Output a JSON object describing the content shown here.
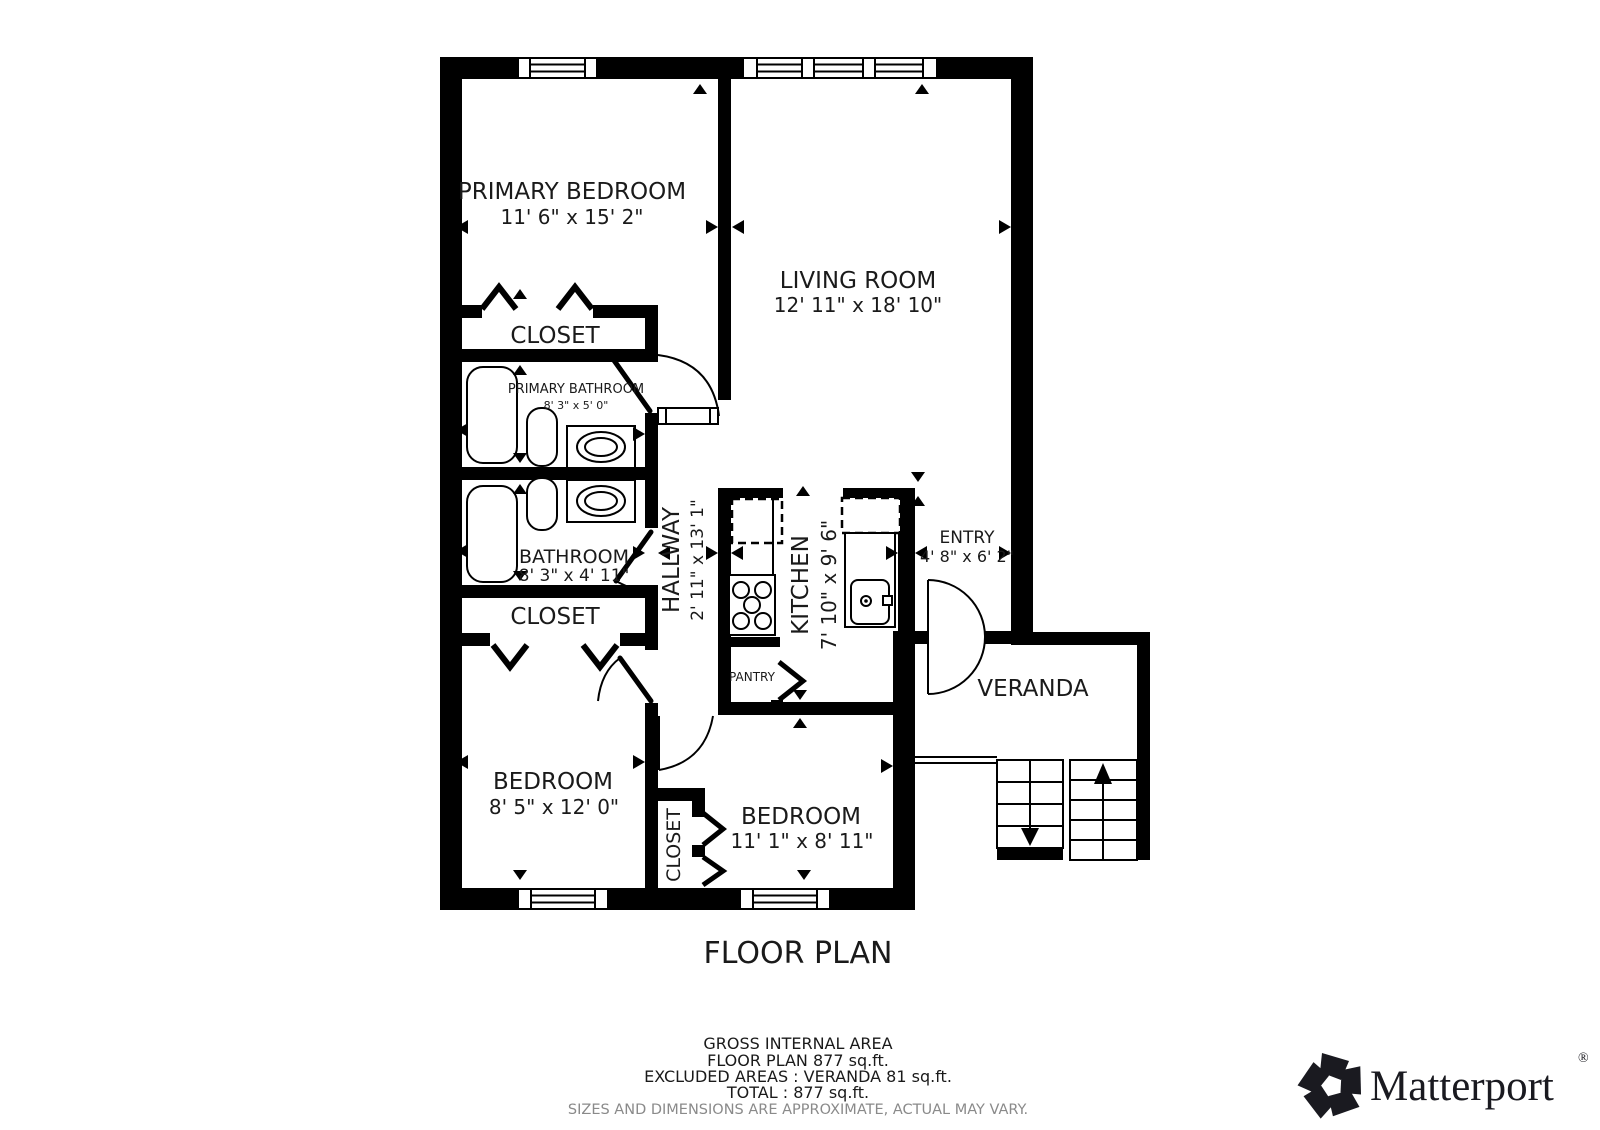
{
  "floor_plan": {
    "title": "FLOOR PLAN",
    "rooms": {
      "primary_bedroom": {
        "name": "PRIMARY BEDROOM",
        "dims": "11' 6\" x 15' 2\""
      },
      "living_room": {
        "name": "LIVING ROOM",
        "dims": "12' 11\" x 18' 10\""
      },
      "closet_top": {
        "name": "CLOSET"
      },
      "primary_bathroom": {
        "name": "PRIMARY BATHROOM",
        "dims": "8' 3\" x 5' 0\""
      },
      "bathroom": {
        "name": "BATHROOM",
        "dims": "8' 3\" x 4' 11\""
      },
      "closet_mid": {
        "name": "CLOSET"
      },
      "hallway": {
        "name": "HALLWAY",
        "dims": "2' 11\" x 13' 1\""
      },
      "kitchen": {
        "name": "KITCHEN",
        "dims": "7' 10\" x 9' 6\""
      },
      "pantry": {
        "name": "PANTRY"
      },
      "entry": {
        "name": "ENTRY",
        "dims": "4' 8\" x 6' 2\""
      },
      "veranda": {
        "name": "VERANDA"
      },
      "bedroom_left": {
        "name": "BEDROOM",
        "dims": "8' 5\" x 12' 0\""
      },
      "bedroom_right": {
        "name": "BEDROOM",
        "dims": "11' 1\" x 8' 11\""
      },
      "closet_between": {
        "name": "CLOSET"
      }
    },
    "footer": {
      "line1": "GROSS INTERNAL AREA",
      "line2": "FLOOR PLAN 877 sq.ft.",
      "line3": "EXCLUDED AREAS :  VERANDA 81 sq.ft.",
      "line4": "TOTAL :  877 sq.ft.",
      "disclaimer": "SIZES AND DIMENSIONS ARE APPROXIMATE, ACTUAL MAY VARY."
    },
    "branding": {
      "logo_text": "Matterport",
      "registered_mark": "®"
    },
    "colors": {
      "wall": "#000000",
      "text": "#1a1a1a",
      "disclaimer_text": "#8a8a8a",
      "logo": "#1a1a20"
    }
  }
}
